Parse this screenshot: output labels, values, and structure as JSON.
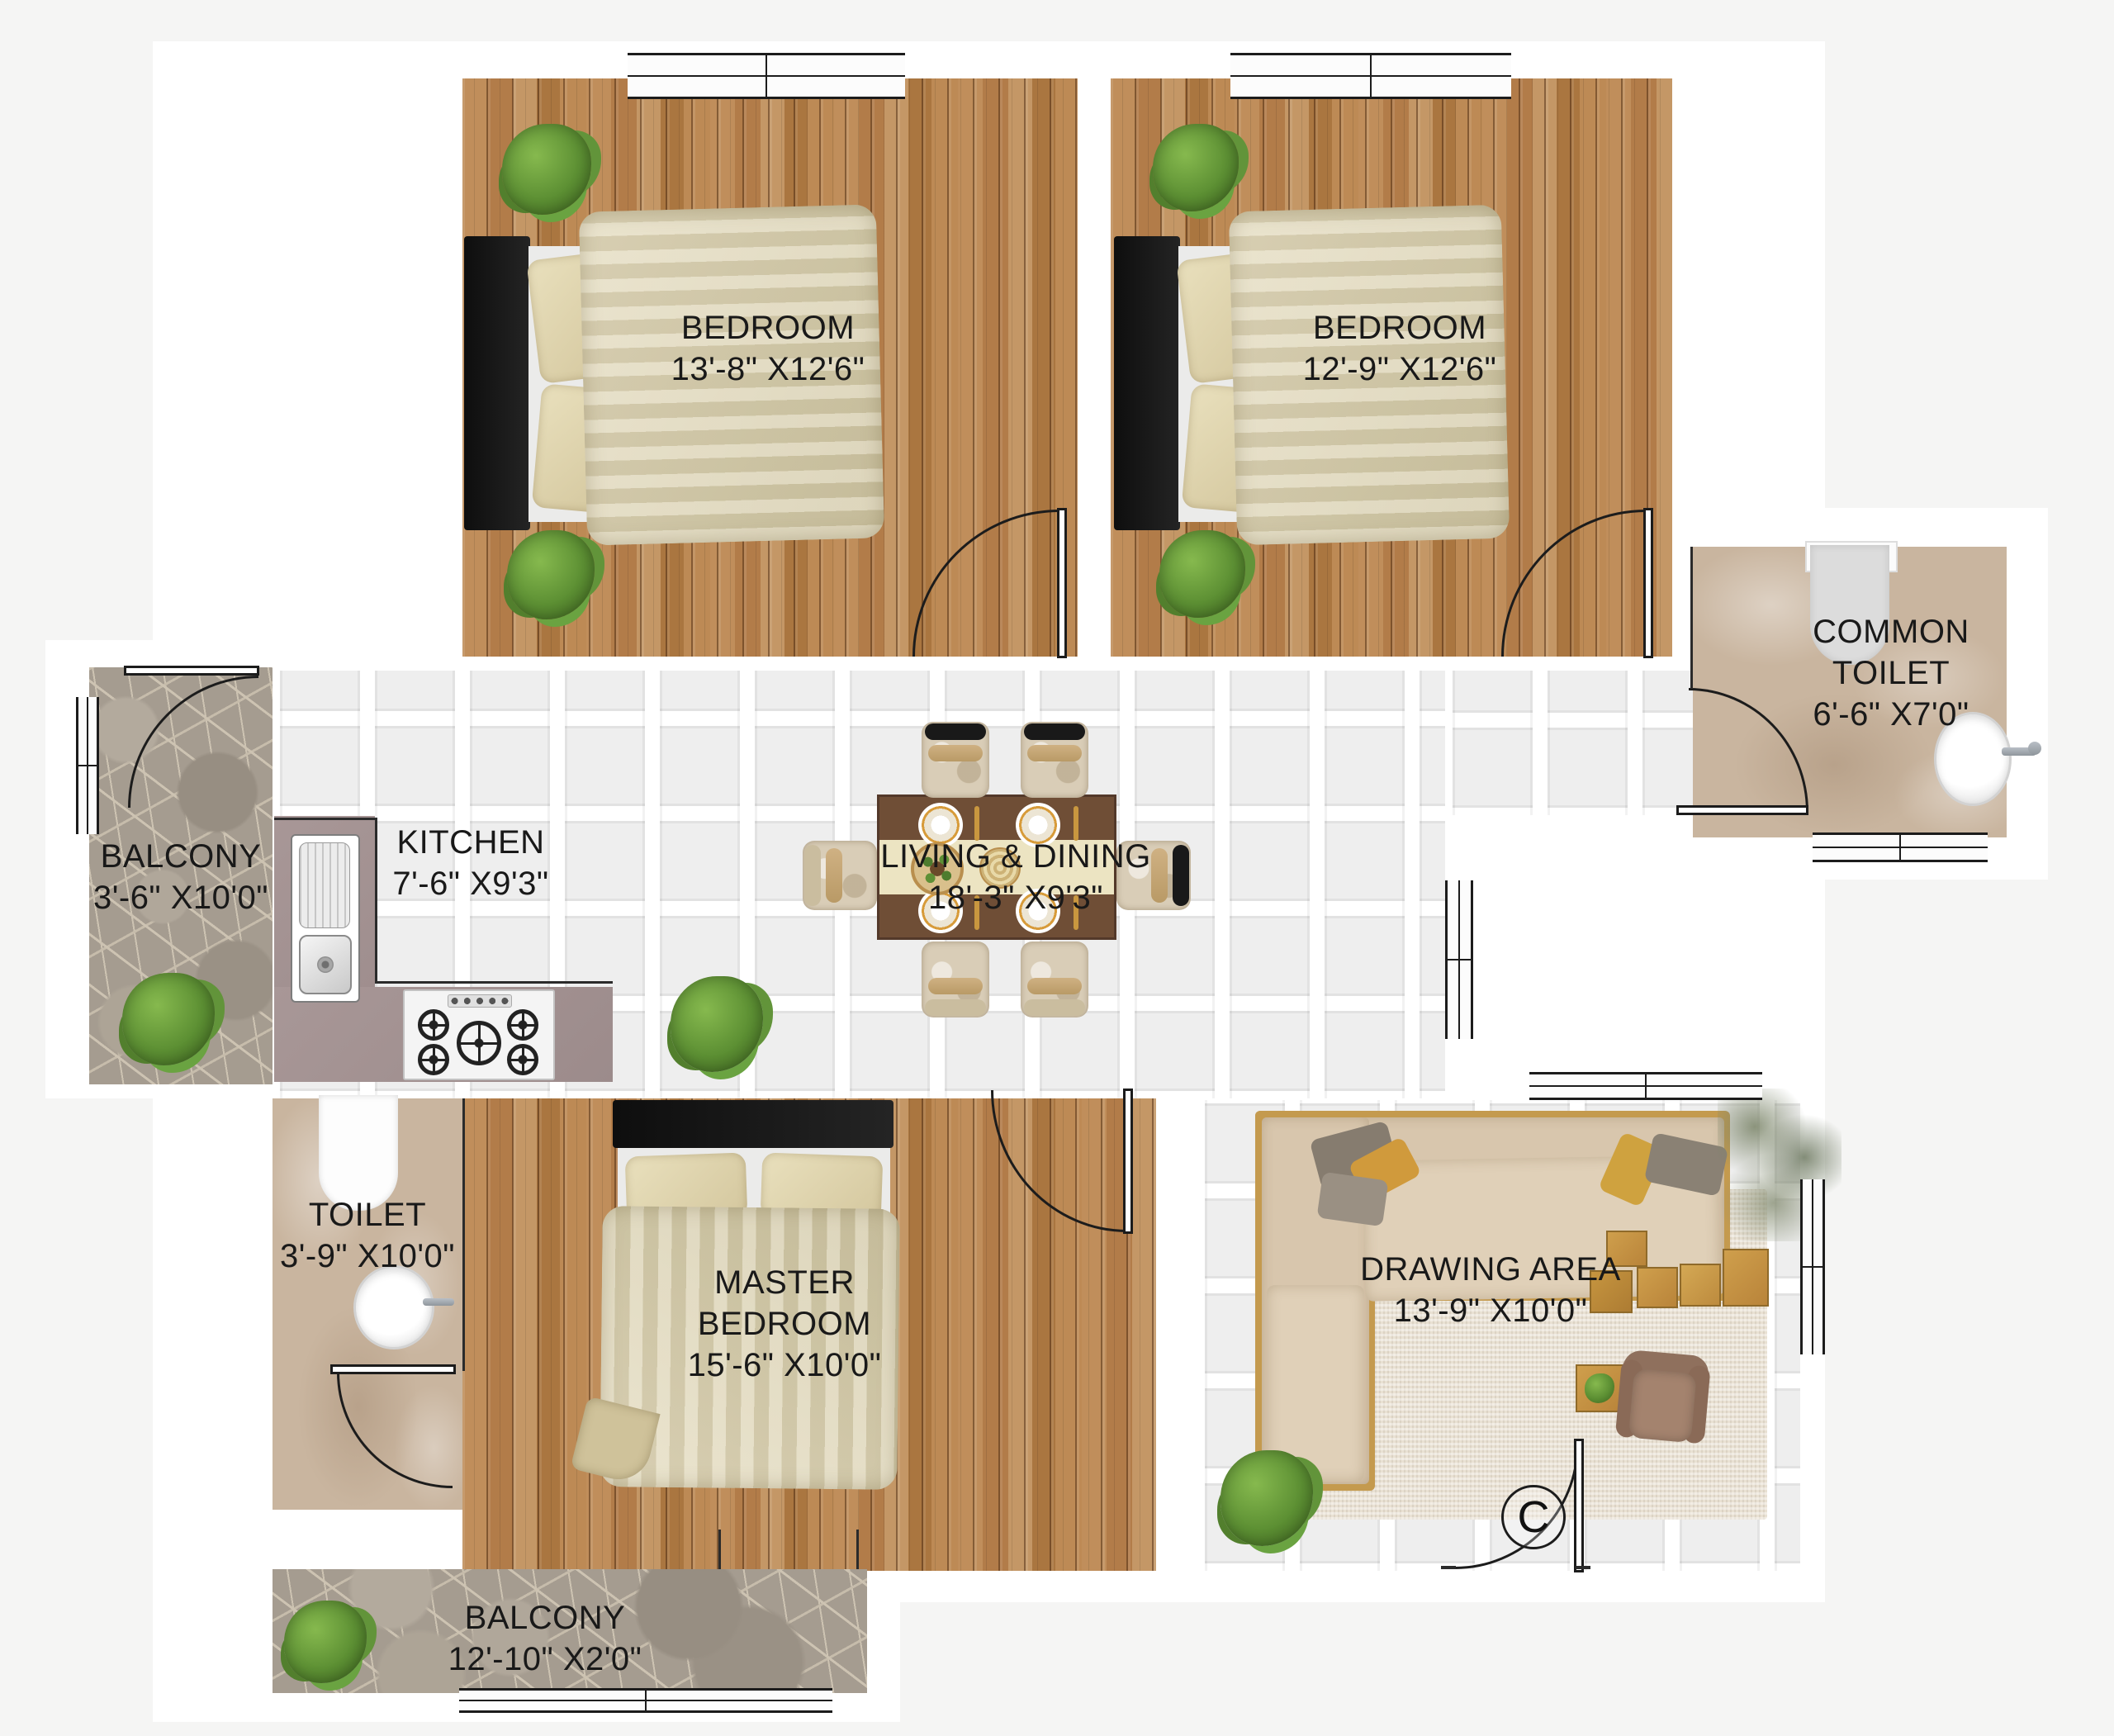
{
  "plan": {
    "rooms": {
      "bedroom_1": {
        "name": "BEDROOM",
        "dims": "13'-8\" X12'6\""
      },
      "bedroom_2": {
        "name": "BEDROOM",
        "dims": "12'-9\" X12'6\""
      },
      "common_toilet": {
        "name": "COMMON TOILET",
        "dims": "6'-6\" X7'0\""
      },
      "balcony_left": {
        "name": "BALCONY",
        "dims": "3'-6\" X10'0\""
      },
      "kitchen": {
        "name": "KITCHEN",
        "dims": "7'-6\" X9'3\""
      },
      "living_dining": {
        "name": "LIVING & DINING",
        "dims": "18'-3\" X9'3\""
      },
      "toilet": {
        "name": "TOILET",
        "dims": "3'-9\" X10'0\""
      },
      "master_bedroom": {
        "name": "MASTER BEDROOM",
        "dims": "15'-6\" X10'0\""
      },
      "drawing_area": {
        "name": "DRAWING AREA",
        "dims": "13'-9\" X10'0\""
      },
      "balcony_bottom": {
        "name": "BALCONY",
        "dims": "12'-10\" X2'0\""
      }
    },
    "entrance": {
      "label": "C"
    },
    "colors": {
      "wood": "#b5854f",
      "tile": "#eeeeee",
      "marble": "#c9b59f",
      "stone": "#a59c90",
      "counter": "#a09090",
      "linen": "#dcd1ab",
      "line": "#1c1c1c",
      "sofa": "#d8c6ad"
    }
  }
}
